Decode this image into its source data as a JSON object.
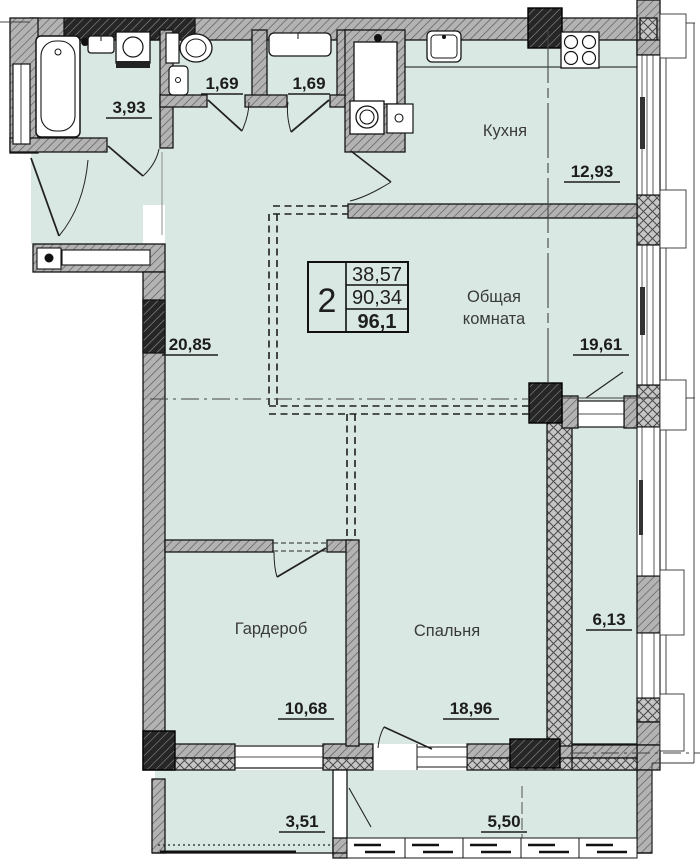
{
  "plan": {
    "legend": {
      "rooms_count": "2",
      "living_area": "38,57",
      "apartment_area": "90,34",
      "total_area": "96,1"
    },
    "rooms": {
      "bathroom": {
        "area": "3,93"
      },
      "wc1": {
        "area": "1,69"
      },
      "wc2": {
        "area": "1,69"
      },
      "kitchen": {
        "name": "Кухня",
        "area": "12,93"
      },
      "hall": {
        "area": "20,85"
      },
      "living": {
        "name_line1": "Общая",
        "name_line2": "комната",
        "area": "19,61"
      },
      "wardrobe": {
        "name": "Гардероб",
        "area": "10,68"
      },
      "bedroom": {
        "name": "Спальня",
        "area": "18,96"
      },
      "loggia": {
        "area": "6,13"
      },
      "balcony_left": {
        "area": "3,51"
      },
      "balcony_right": {
        "area": "5,50"
      }
    },
    "colors": {
      "room_fill": "#d9e8e3",
      "wall_gray": "#b3b3b3",
      "outline": "#1a1a1a"
    }
  }
}
